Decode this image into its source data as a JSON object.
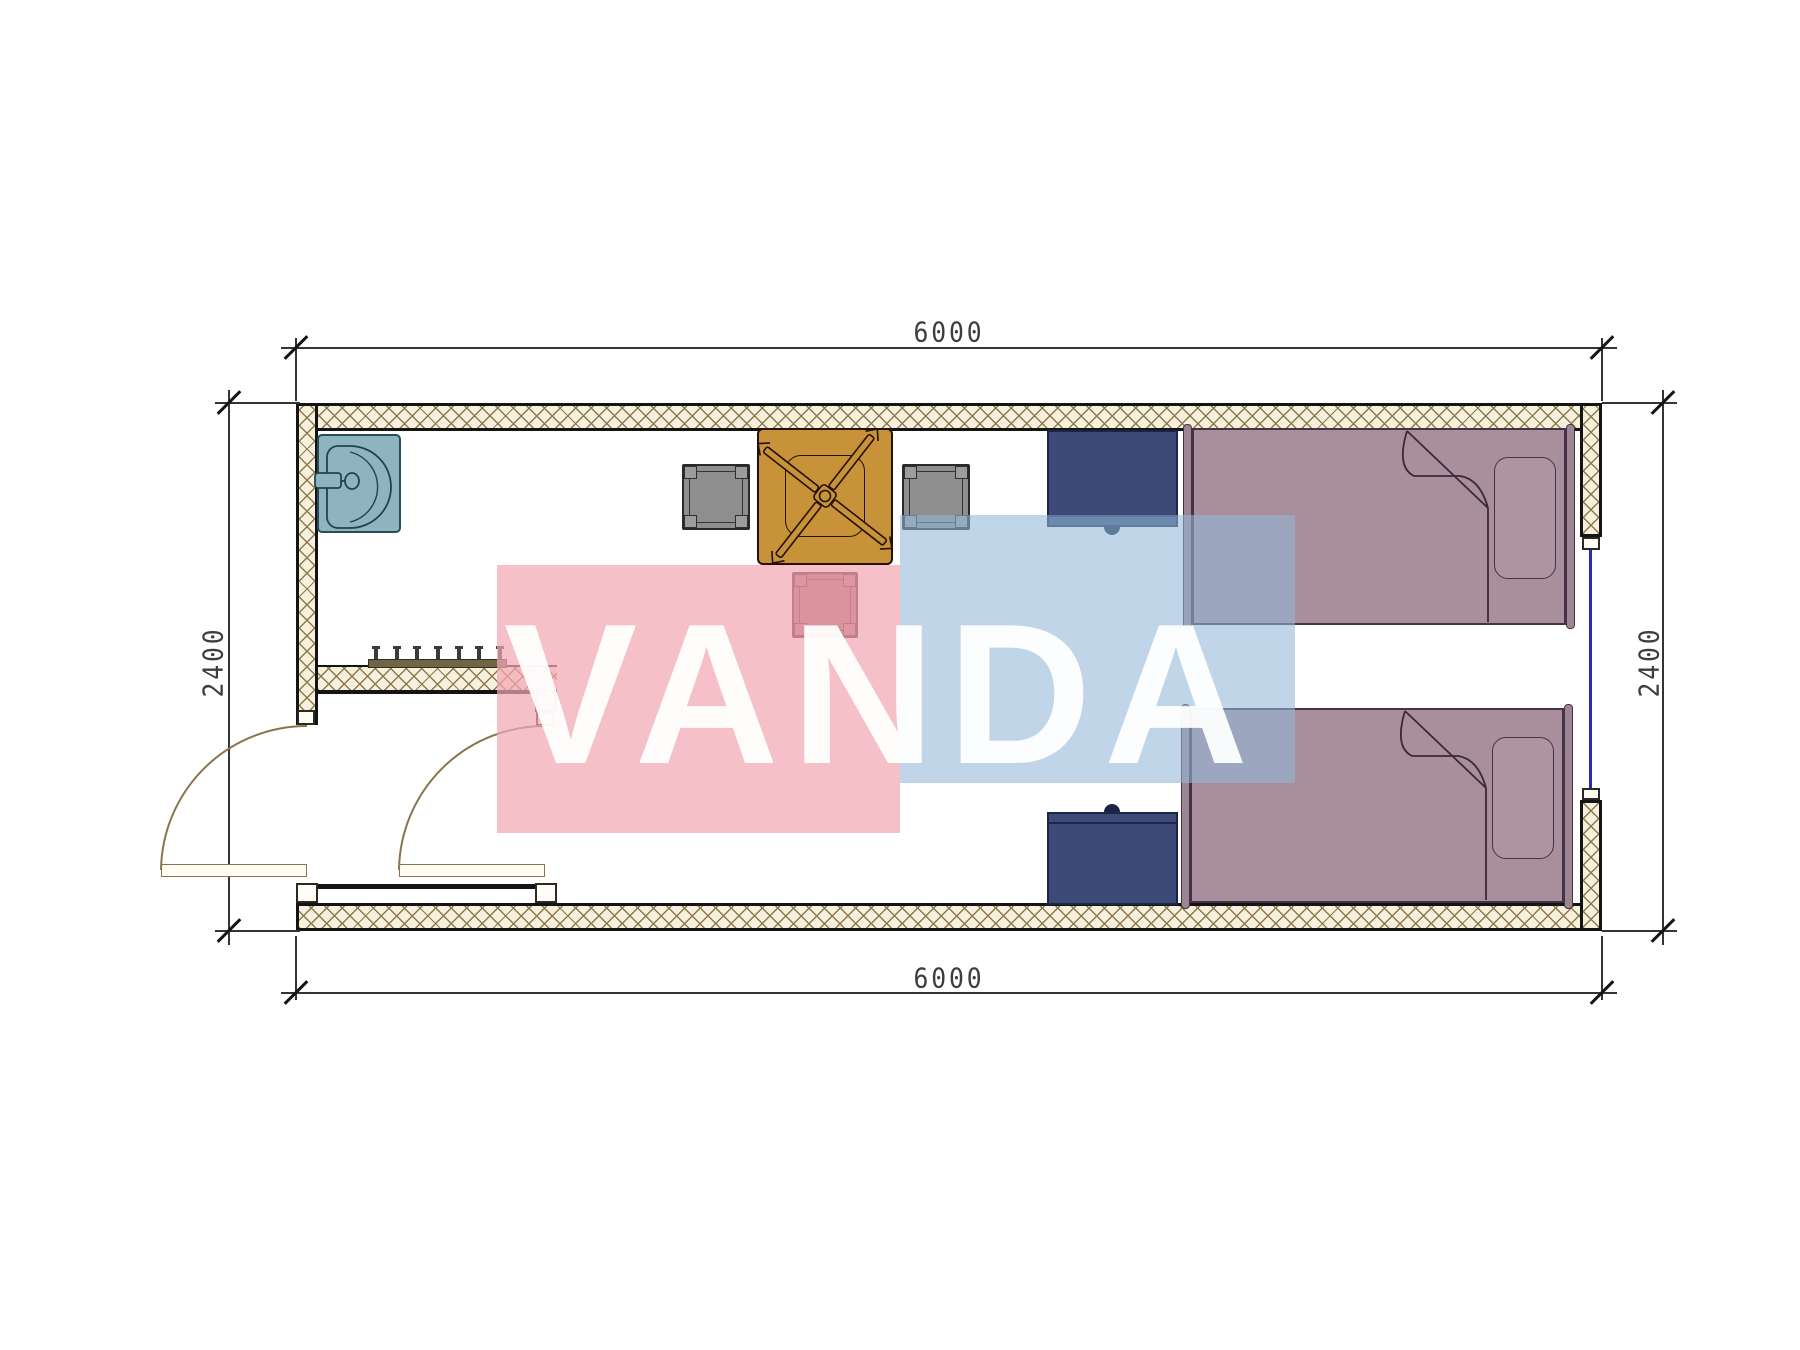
{
  "drawing": {
    "type": "architectural floor plan",
    "description": "Single container room 6000 x 2400 with entry vestibule, sink, table with fan, two chairs, stool, coat rack, two nightstands, two single beds, two swing doors and one window"
  },
  "dimensions": {
    "top": "6000",
    "bottom": "6000",
    "left": "2400",
    "right": "2400"
  },
  "watermark": {
    "text": "VANDA",
    "pink_color": "rgba(243,167,180,0.72)",
    "blue_color": "rgba(146,183,216,0.58)",
    "text_color": "rgba(255,255,255,0.94)"
  },
  "coat_rack": {
    "hook_count": 7
  },
  "furniture": [
    "sink",
    "square-table",
    "fan-symbol",
    "chair-left",
    "chair-right",
    "stool",
    "nightstand-top",
    "nightstand-bottom",
    "bed-top",
    "bed-bottom",
    "pillow-top",
    "pillow-bottom",
    "coat-rack",
    "door-left",
    "door-right",
    "window-right"
  ],
  "colors": {
    "wall-line": "#141414",
    "hatch-bg": "#f6f0dd",
    "hatch-line": "#8c7a4c",
    "dim": "#3d3d3d",
    "bed": "#a98f9b",
    "bed-line": "#463147",
    "navy": "#3d4a78",
    "navy-dark": "#1b2647",
    "sink": "#8fb4c1",
    "sink-line": "#2c4b59",
    "table": "#c79238",
    "table-line": "#241103",
    "chair": "#8e8e8e",
    "chair-line": "#2a2a2a",
    "stool": "#9d5f63",
    "stool-line": "#43171c",
    "rack": "#6f6547",
    "door": "#8a744c",
    "window": "#2b2bb0",
    "wm-pink": "rgba(243,167,180,0.72)",
    "wm-blue": "rgba(146,183,216,0.58)",
    "wm-text": "rgba(255,255,255,0.94)"
  }
}
